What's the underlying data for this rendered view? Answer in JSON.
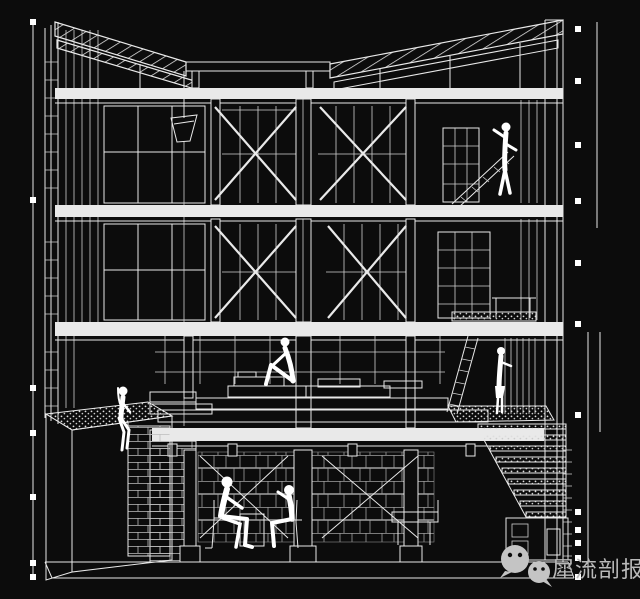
{
  "canvas": {
    "width": 640,
    "height": 599,
    "background": "#0c0c0c",
    "line_color": "#e9e9e9"
  },
  "watermark": {
    "text": "犀流剖报",
    "color": "#b9b9b9",
    "icon": "wechat-logo",
    "icon_color": "#c4c4c4"
  },
  "drawing": {
    "type": "architectural-sectional-perspective",
    "style": "white wireframe on black",
    "levels": [
      "butterfly roof with trussed slopes",
      "upper floor",
      "middle floor",
      "mezzanine platform",
      "basement",
      "ground slab"
    ],
    "features": [
      "x-braced bays with glazed mullion walls",
      "rain chain with hopper at roof valley",
      "gravel planter terrace (left)",
      "gravel stair treads to landing (right)",
      "shelving units (right bays)",
      "ladder to platform"
    ],
    "figures": [
      "person standing at shelves (upper right)",
      "person sitting on platform edge (center)",
      "person sitting on planter ledge (left)",
      "person standing at stair landing (right)",
      "two people seated on chairs (basement)"
    ],
    "dimension_markers": {
      "left_count": 7,
      "right_count": 12
    }
  }
}
